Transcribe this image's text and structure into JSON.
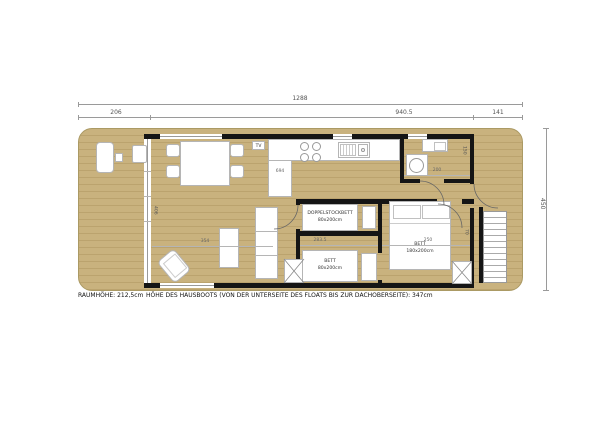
{
  "dims": {
    "overall_length": "1288",
    "front_deck": "206",
    "cabin": "940.5",
    "rear_deck": "141",
    "overall_width": "450",
    "living_length": "354",
    "living_width": "406",
    "kitchen_len": "694",
    "bedrooms_span": "283.5",
    "bedroom_right_width": "250",
    "bath_width": "200",
    "bath_depth": "150",
    "door_width": "70"
  },
  "rooms": {
    "tv_label": "TV",
    "bunk": {
      "line1": "DOPPELSTOCKBETT",
      "line2": "80x200cm"
    },
    "small_bed": {
      "line1": "BETT",
      "line2": "80x200cm"
    },
    "large_bed": {
      "line1": "BETT",
      "line2": "180x200cm"
    }
  },
  "footer": {
    "room_height": "RAUMHÖHE: 212,5cm",
    "boat_height": "HÖHE DES HAUSBOOTS (VON DER UNTERSEITE DES FLOATS BIS ZUR DACHOBERSEITE): 347cm"
  },
  "colors": {
    "wood": "#c9b27e",
    "plank_line": "#bba36e",
    "wall": "#151515",
    "dim_line": "#9a9a9a",
    "dim_text": "#555555",
    "furniture_border": "#b5b5b5"
  }
}
